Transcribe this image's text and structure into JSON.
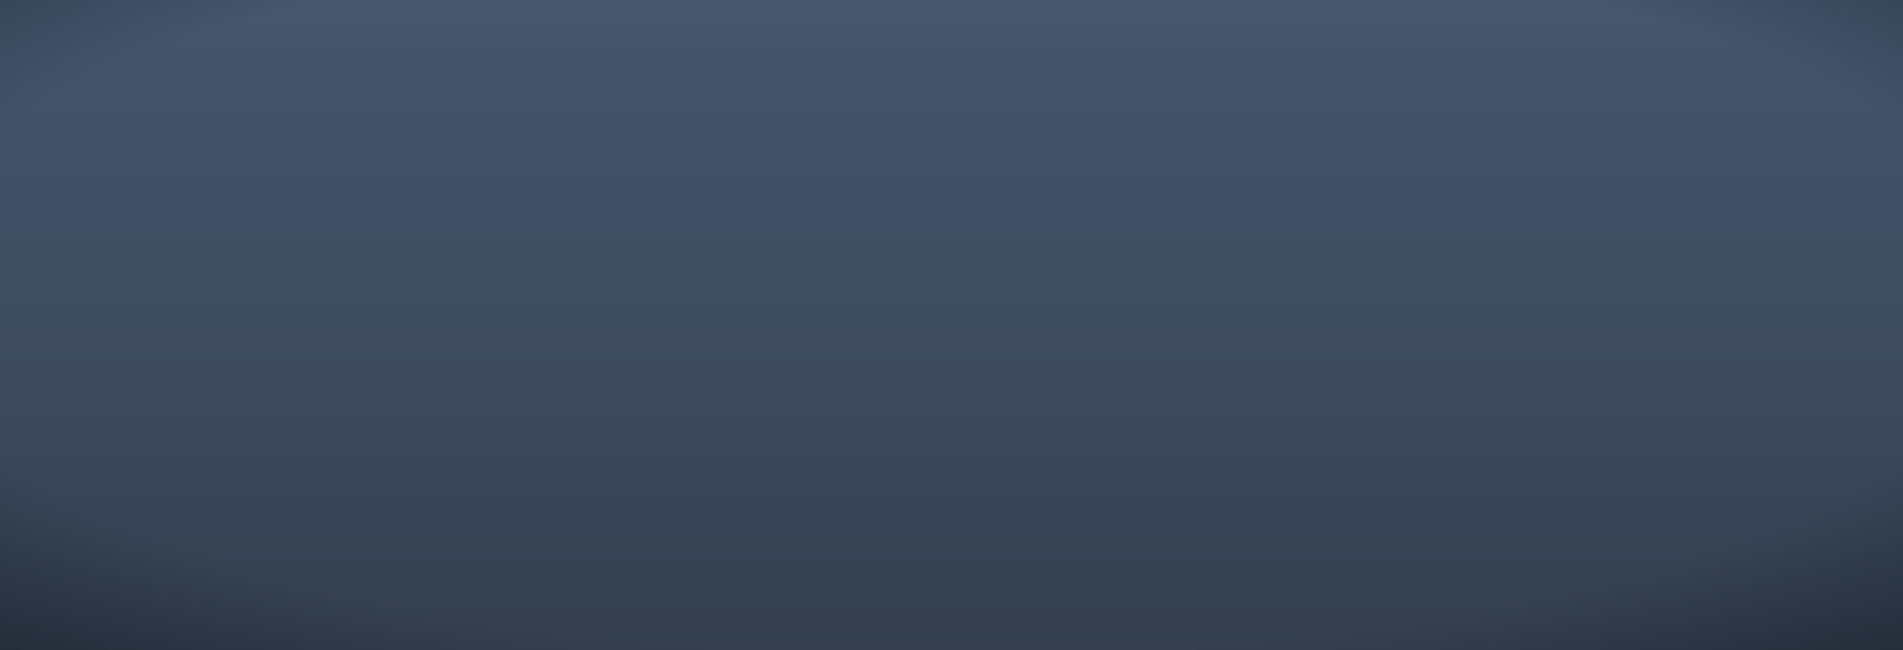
{
  "overlay": {
    "project_title": "新建湖北荆州民用机场工程"
  },
  "terminal": {
    "roof_sign": "荆州"
  },
  "palette": {
    "sign_red": "#c2392b",
    "watermark_ink": "#0d0d0d",
    "watermark_outline": "#ffffff",
    "roof_white": "#e9f0f8",
    "roof_shade": "#9db0c6",
    "glass_glow": "#f6d6a0",
    "airfield_pavement": "#4e5e75",
    "airside_grass": "#2b3b37",
    "tree_dark": "#1c2d23",
    "tree_lit": "#8e9a4a",
    "hedge_green": "#3a5134",
    "blossom_pink": "#c893bb",
    "water": "#2c425f",
    "walkway_blue": "#9fd6ec",
    "lamp_warm": "#ffd9a0",
    "road_marking_yellow": "#d0a04a",
    "parking_asphalt": "#525d70"
  }
}
